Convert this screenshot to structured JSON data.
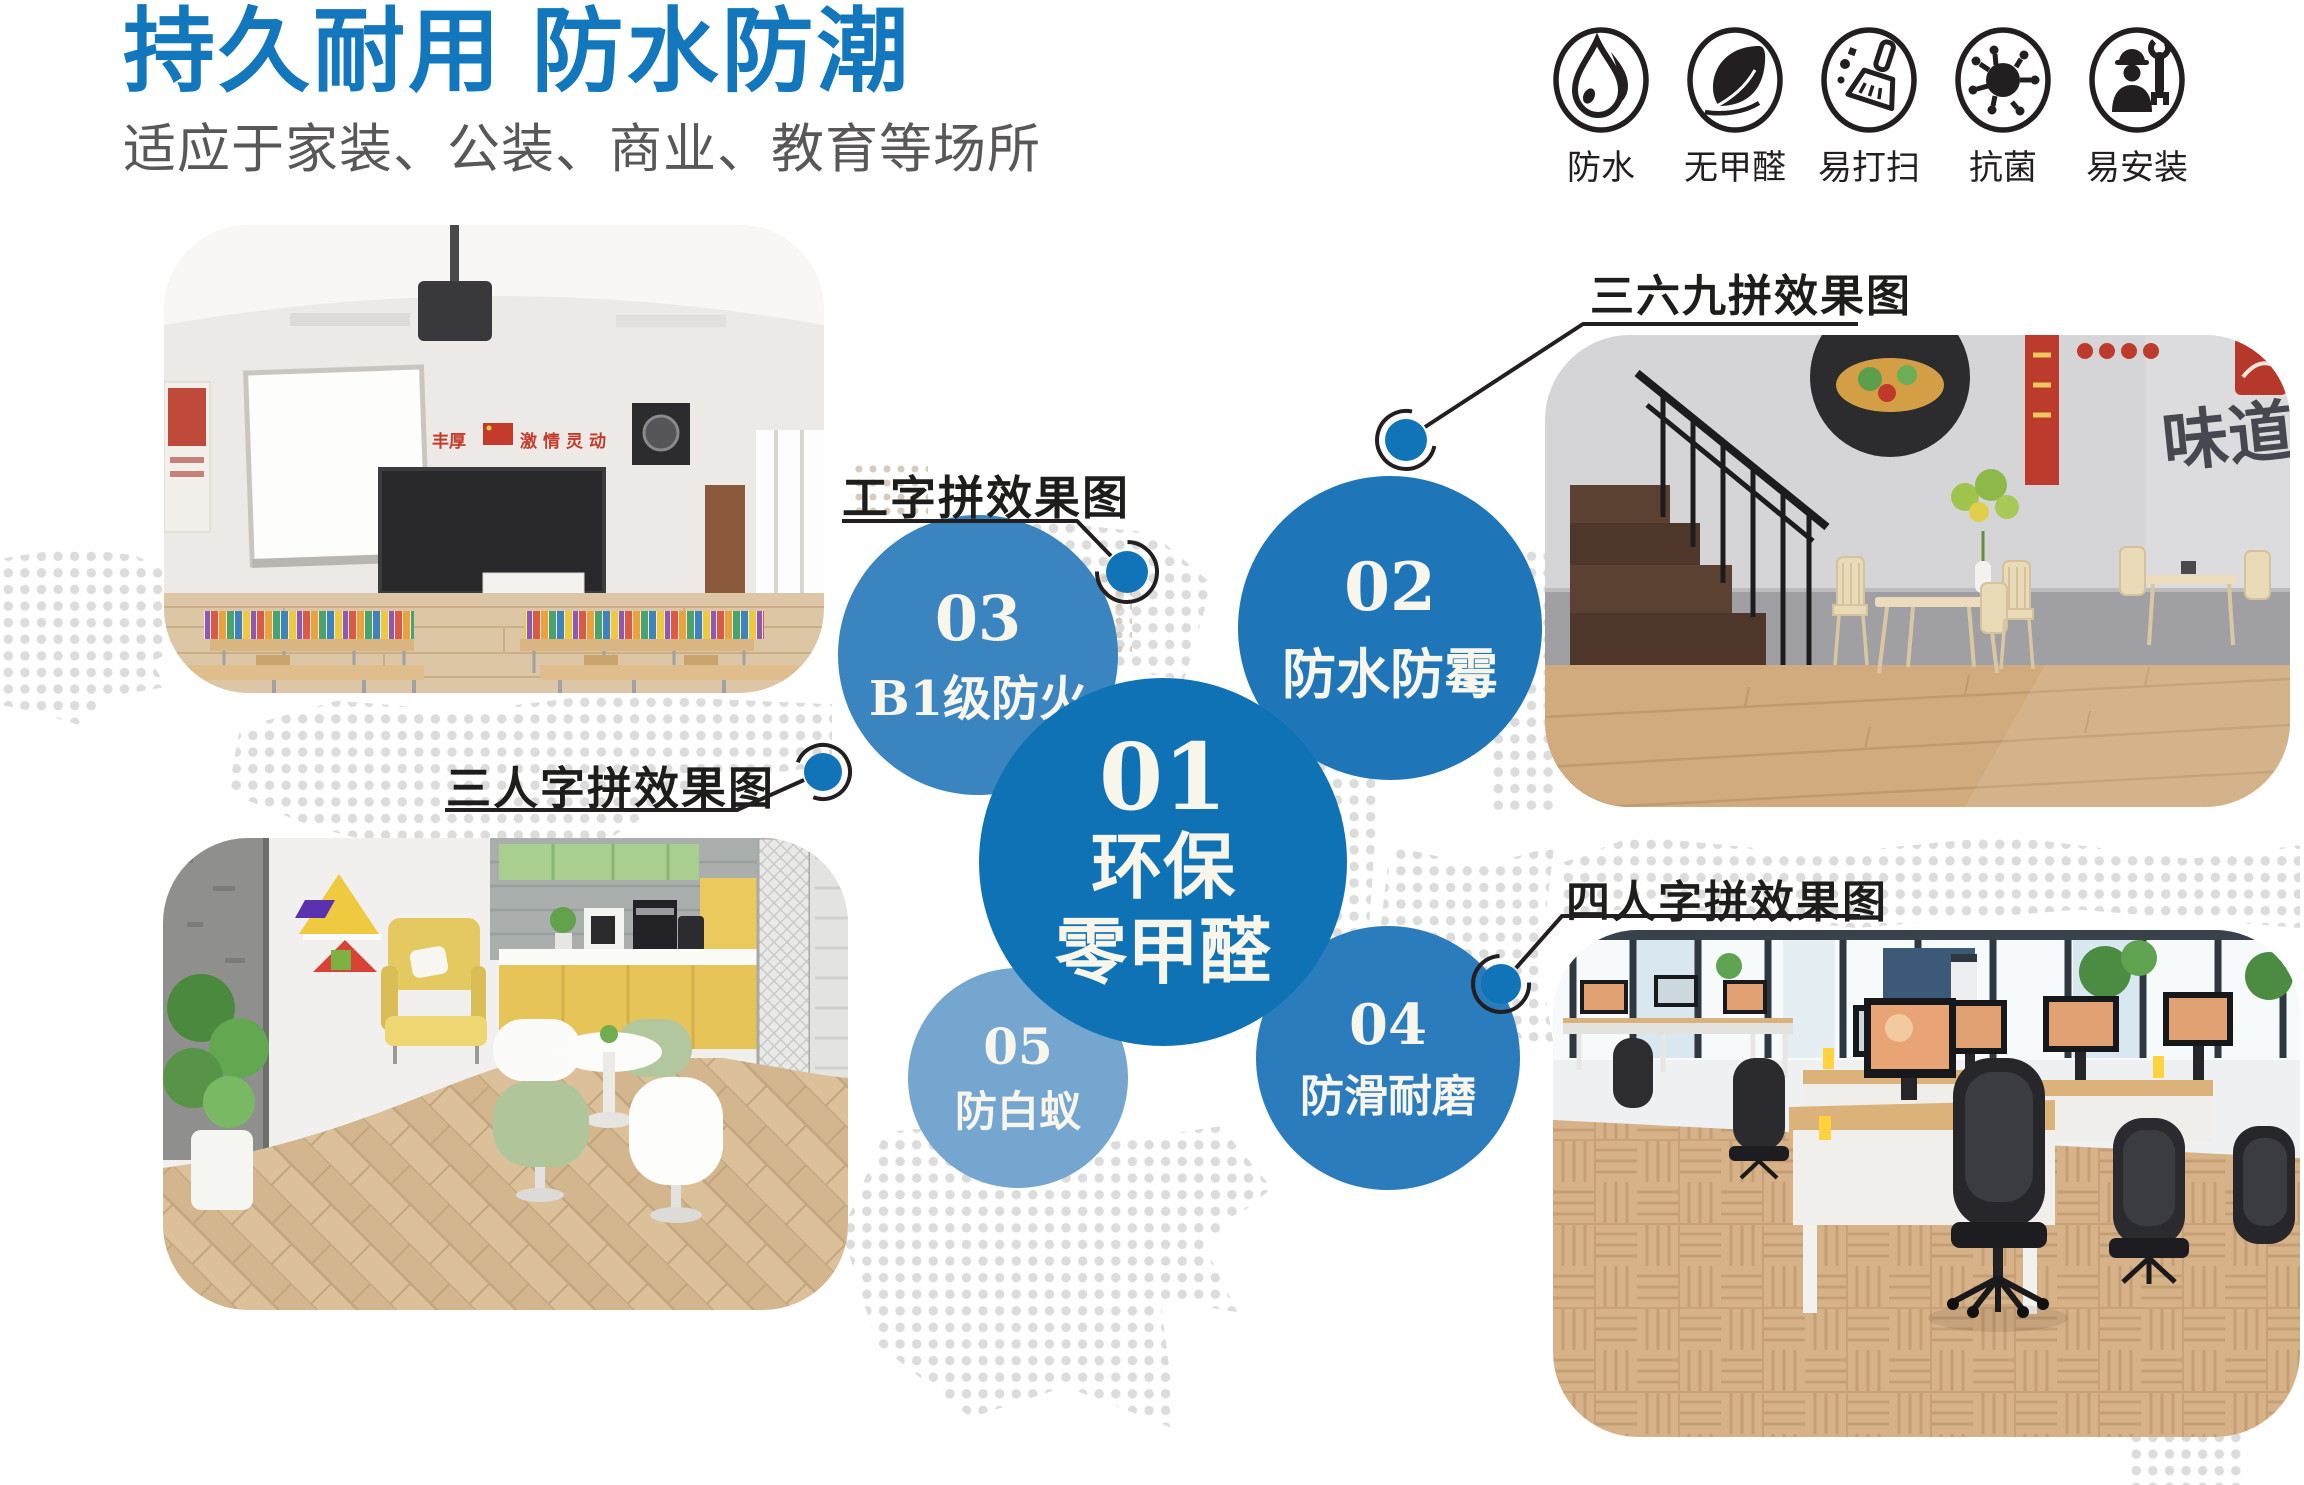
{
  "page": {
    "width": 2304,
    "height": 1485,
    "background": "#ffffff"
  },
  "header": {
    "title": "持久耐用 防水防潮",
    "title_color": "#1277bd",
    "subtitle": "适应于家装、公装、商业、教育等场所",
    "subtitle_color": "#595757"
  },
  "features": {
    "items": [
      {
        "icon": "water-drop-icon",
        "label": "防水"
      },
      {
        "icon": "leaf-icon",
        "label": "无甲醛"
      },
      {
        "icon": "broom-icon",
        "label": "易打扫"
      },
      {
        "icon": "virus-icon",
        "label": "抗菌"
      },
      {
        "icon": "installer-icon",
        "label": "易安装"
      }
    ]
  },
  "diagram": {
    "bubbles": [
      {
        "num": "01",
        "line1": "环保",
        "line2": "零甲醛",
        "color": "#0f72b5"
      },
      {
        "num": "02",
        "label": "防水防霉",
        "color": "#1e76b8"
      },
      {
        "num": "03",
        "label": "B1级防火",
        "color": "#3a85c0"
      },
      {
        "num": "04",
        "label": "防滑耐磨",
        "color": "#2b7cbc"
      },
      {
        "num": "05",
        "label": "防白蚁",
        "color": "#74a6d0"
      }
    ],
    "callouts": [
      {
        "label": "工字拼效果图"
      },
      {
        "label": "三六九拼效果图"
      },
      {
        "label": "三人字拼效果图"
      },
      {
        "label": "四人字拼效果图"
      }
    ],
    "dot_color": "#1173b8",
    "line_color": "#231f20"
  },
  "photos": {
    "classroom": {
      "name": "classroom-scene",
      "banner_left": "丰厚",
      "banner_right": "激情灵动"
    },
    "restaurant": {
      "name": "restaurant-scene",
      "mural_text": "味道"
    },
    "lounge": {
      "name": "lounge-scene"
    },
    "office": {
      "name": "office-scene"
    }
  },
  "background": {
    "dot_color": "#dcdcdc",
    "dot_beige": "#d9cbbb"
  }
}
